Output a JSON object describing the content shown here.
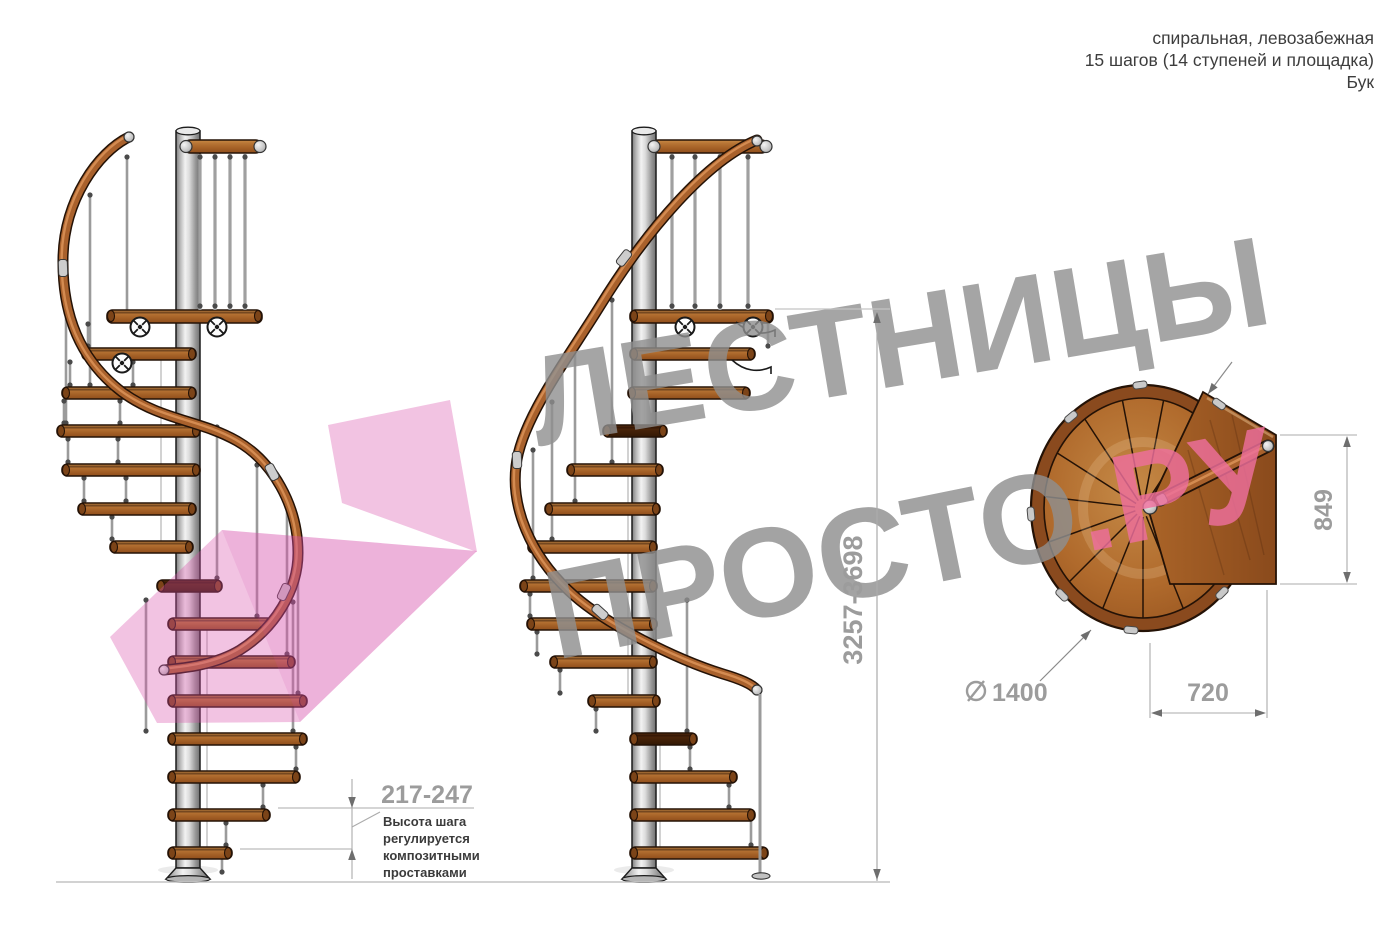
{
  "header": {
    "line1": "спиральная, левозабежная",
    "line2": "15 шагов (14 ступеней и площадка)",
    "line3": "Бук"
  },
  "watermark": {
    "brand_line1": "ЛЕСТНИЦЫ",
    "brand_line2": "ПРОСТО",
    "brand_suffix": ".РУ",
    "gray": "#8f8f8f",
    "pink": "#ee6f9d",
    "arrow_pink": "#d850aa"
  },
  "dimensions": {
    "total_height": "3257-3698",
    "step_height": "217-247",
    "landing_depth": "849",
    "landing_width": "720",
    "diameter": "1400"
  },
  "note": {
    "lines": [
      "Высота шага",
      "регулируется",
      "композитными",
      "проставками"
    ]
  },
  "materials": {
    "wood": "#a9612c",
    "steel": "#c9c9c9",
    "dim_gray": "#9c9c9c",
    "text_dark": "#3b3b3b"
  }
}
